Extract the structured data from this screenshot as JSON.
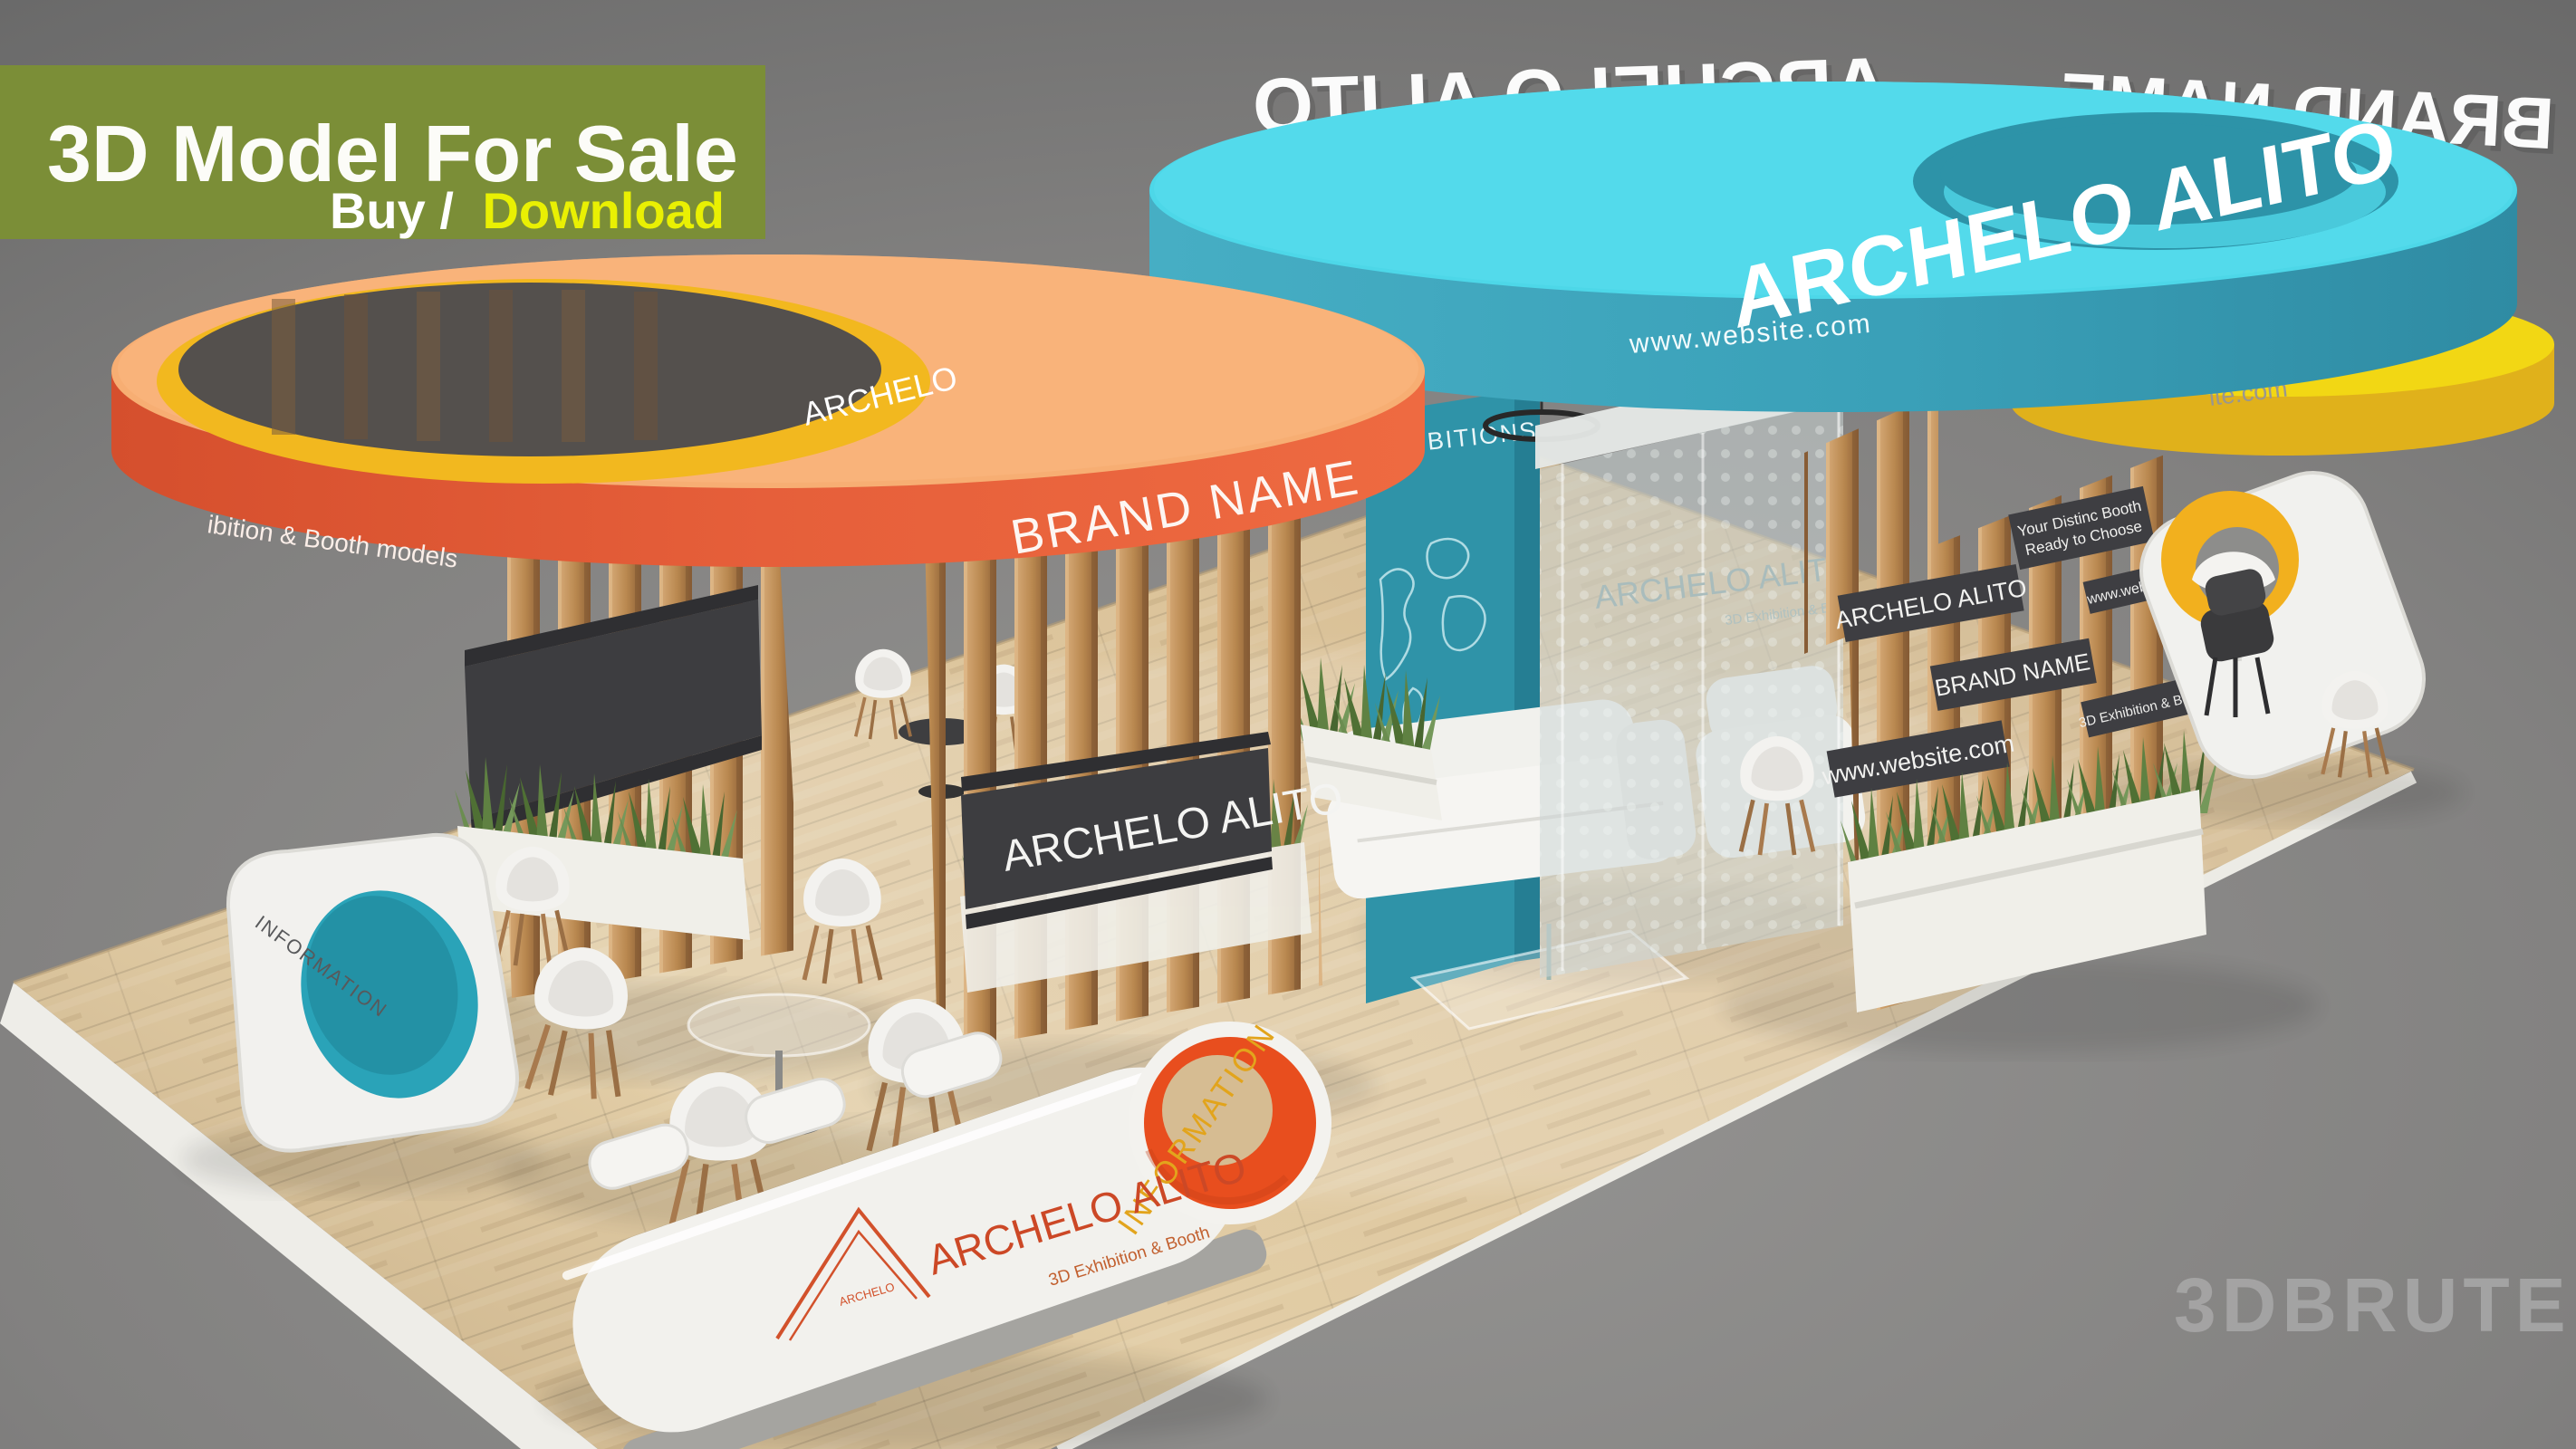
{
  "banner": {
    "title": "3D Model For Sale",
    "buy_label": "Buy /",
    "download_label": "Download",
    "bg_color": "#7b8e37",
    "download_color": "#e9f003"
  },
  "watermark": {
    "text": "3DBRUTE"
  },
  "orange_zone": {
    "rim_brand": "BRAND NAME",
    "side_partial": "ibition & Booth models",
    "inner_ring_partial": "ARCHELO",
    "band_brand": "ARCHELO ALITO",
    "disc_top_color": "#f7ae73",
    "disc_rim_color": "#e2593a",
    "inner_ring_color": "#f2b81f"
  },
  "teal_zone": {
    "top_brand": "ARCHELO ALITO",
    "rim_website": "www.website.com",
    "back_left_mirrored": "ARCHELO ALITO",
    "back_right_mirrored": "BRAND NAME",
    "disc_top_color": "#4dd7e8",
    "disc_rim_color": "#3aa0b8"
  },
  "yellow_disc": {
    "rim_partial": "ite.com",
    "top_color": "#f2d714",
    "rim_color": "#e0b11b"
  },
  "map_wall": {
    "partial_text": "HIBITIONS",
    "color": "#2f93a8"
  },
  "glass_wall": {
    "etched_title": "ARCHELO ALITO",
    "etched_sub": "3D Exhibition & Booth"
  },
  "panel_signs": {
    "sign1": "ARCHELO ALITO",
    "sign2": "BRAND NAME",
    "sign3": "www.website.com",
    "sign4": "www.website.com",
    "sign5_line1": "Your Distinc Booth",
    "sign5_line2": "Ready to Choose",
    "sign6": "3D Exhibition & Booth",
    "bg_color": "#3e3e42"
  },
  "counters": {
    "left_label": "INFORMATION",
    "center_ring_label": "INFORMATION",
    "logo_title": "ARCHELO ALITO",
    "logo_sub": "3D Exhibition & Booth",
    "logo_mark": "ARCHELO"
  }
}
